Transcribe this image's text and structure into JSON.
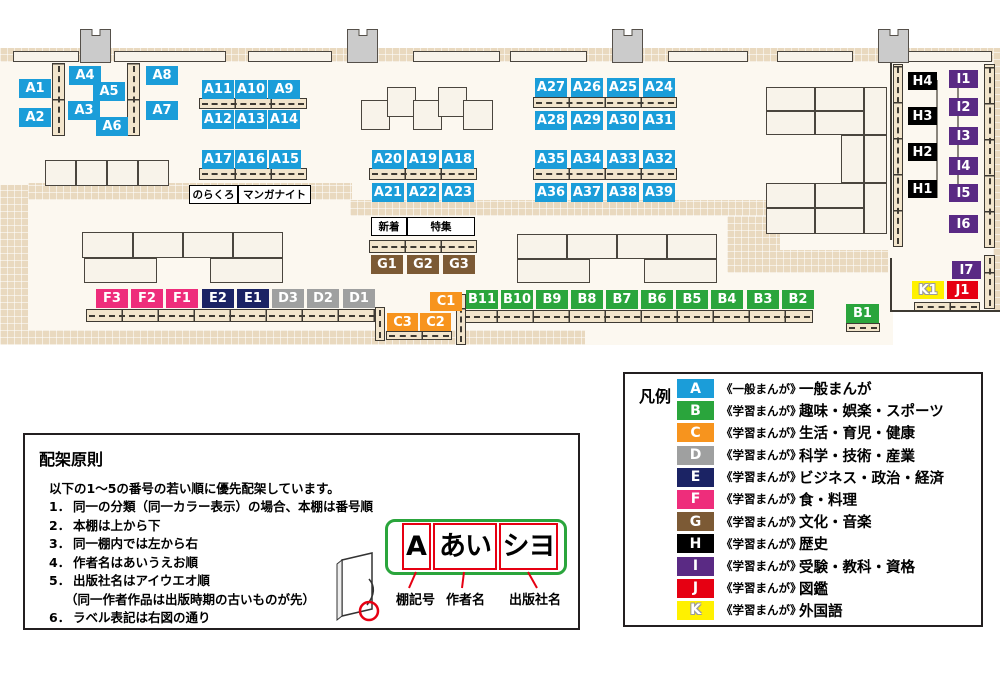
{
  "legend": {
    "title": "凡例",
    "items": [
      {
        "code": "A",
        "color": "#1b9dd9",
        "series": "《一般まんが》",
        "category": "一般まんが"
      },
      {
        "code": "B",
        "color": "#2aa53c",
        "series": "《学習まんが》",
        "category": "趣味・娯楽・スポーツ"
      },
      {
        "code": "C",
        "color": "#f7941e",
        "series": "《学習まんが》",
        "category": "生活・育児・健康"
      },
      {
        "code": "D",
        "color": "#9fa0a0",
        "series": "《学習まんが》",
        "category": "科学・技術・産業"
      },
      {
        "code": "E",
        "color": "#1b2364",
        "series": "《学習まんが》",
        "category": "ビジネス・政治・経済"
      },
      {
        "code": "F",
        "color": "#ee2d7b",
        "series": "《学習まんが》",
        "category": "食・料理"
      },
      {
        "code": "G",
        "color": "#7c5a35",
        "series": "《学習まんが》",
        "category": "文化・音楽"
      },
      {
        "code": "H",
        "color": "#000000",
        "series": "《学習まんが》",
        "category": "歴史"
      },
      {
        "code": "I",
        "color": "#5a2a84",
        "series": "《学習まんが》",
        "category": "受験・教科・資格"
      },
      {
        "code": "J",
        "color": "#e60012",
        "series": "《学習まんが》",
        "category": "図鑑"
      },
      {
        "code": "K",
        "color": "#fff100",
        "series": "《学習まんが》",
        "category": "外国語"
      }
    ]
  },
  "principles": {
    "title": "配架原則",
    "intro": "以下の1～5の番号の若い順に優先配架しています。",
    "items": [
      {
        "num": "1．",
        "text": "同一の分類（同一カラー表示）の場合、本棚は番号順",
        "sub": false
      },
      {
        "num": "2．",
        "text": "本棚は上から下",
        "sub": false
      },
      {
        "num": "3．",
        "text": "同一棚内では左から右",
        "sub": false
      },
      {
        "num": "4．",
        "text": "作者名はあいうえお順",
        "sub": false
      },
      {
        "num": "5．",
        "text": "出版社名はアイウエオ順",
        "sub": false
      },
      {
        "num": "",
        "text": "（同一作者作品は出版時期の古いものが先）",
        "sub": true
      },
      {
        "num": "6．",
        "text": "ラベル表記は右図の通り",
        "sub": false
      }
    ]
  },
  "label_diagram": {
    "shelf_code": "A",
    "author": "あい",
    "publisher": "シヨ",
    "captions": [
      "棚記号",
      "作者名",
      "出版社名"
    ]
  },
  "map": {
    "floors": [
      [
        0,
        48,
        893,
        297
      ],
      [
        893,
        48,
        107,
        264
      ]
    ],
    "bands": [
      [
        0,
        48,
        1000,
        14
      ],
      [
        0,
        185,
        28,
        160
      ],
      [
        28,
        183,
        324,
        17
      ],
      [
        350,
        200,
        430,
        16
      ],
      [
        727,
        216,
        53,
        57
      ],
      [
        727,
        250,
        161,
        23
      ],
      [
        28,
        330,
        557,
        15
      ],
      [
        993,
        48,
        7,
        264
      ]
    ],
    "walls": [
      [
        890,
        62,
        2,
        178
      ],
      [
        890,
        258,
        2,
        54
      ],
      [
        892,
        310,
        108,
        2
      ]
    ],
    "lines": [
      [
        936,
        80,
        2,
        118
      ],
      [
        957,
        78,
        2,
        116
      ]
    ],
    "pillars": [
      [
        80,
        29,
        31,
        34
      ],
      [
        347,
        29,
        31,
        34
      ],
      [
        612,
        29,
        31,
        34
      ],
      [
        878,
        29,
        31,
        34
      ]
    ],
    "tables": [
      [
        13,
        51,
        66,
        11
      ],
      [
        114,
        51,
        112,
        11
      ],
      [
        248,
        51,
        84,
        11
      ],
      [
        413,
        51,
        87,
        11
      ],
      [
        510,
        51,
        77,
        11
      ],
      [
        668,
        51,
        80,
        11
      ],
      [
        777,
        51,
        76,
        11
      ],
      [
        903,
        51,
        89,
        11
      ],
      [
        45,
        160,
        31,
        26
      ],
      [
        76,
        160,
        31,
        26
      ],
      [
        107,
        160,
        31,
        26
      ],
      [
        138,
        160,
        31,
        26
      ],
      [
        361,
        100,
        29,
        30
      ],
      [
        387,
        87,
        29,
        30
      ],
      [
        413,
        100,
        29,
        30
      ],
      [
        438,
        87,
        29,
        30
      ],
      [
        463,
        100,
        30,
        30
      ],
      [
        82,
        232,
        51,
        26
      ],
      [
        133,
        232,
        50,
        26
      ],
      [
        183,
        232,
        50,
        26
      ],
      [
        233,
        232,
        50,
        26
      ],
      [
        84,
        258,
        73,
        25
      ],
      [
        210,
        258,
        73,
        25
      ],
      [
        517,
        234,
        50,
        25
      ],
      [
        567,
        234,
        50,
        25
      ],
      [
        617,
        234,
        50,
        25
      ],
      [
        667,
        234,
        50,
        25
      ],
      [
        517,
        259,
        73,
        24
      ],
      [
        644,
        259,
        73,
        24
      ],
      [
        766,
        87,
        49,
        24
      ],
      [
        815,
        87,
        49,
        24
      ],
      [
        864,
        87,
        23,
        48
      ],
      [
        766,
        111,
        49,
        24
      ],
      [
        815,
        111,
        49,
        24
      ],
      [
        841,
        135,
        23,
        48
      ],
      [
        864,
        135,
        23,
        48
      ],
      [
        766,
        183,
        49,
        25
      ],
      [
        815,
        183,
        49,
        25
      ],
      [
        864,
        183,
        23,
        51
      ],
      [
        766,
        208,
        49,
        26
      ],
      [
        815,
        208,
        49,
        26
      ]
    ],
    "shelves_h": [
      [
        199,
        98,
        108,
        11
      ],
      [
        199,
        168,
        108,
        12
      ],
      [
        369,
        168,
        108,
        12
      ],
      [
        533,
        97,
        144,
        11
      ],
      [
        533,
        168,
        144,
        12
      ],
      [
        369,
        240,
        108,
        13
      ],
      [
        86,
        309,
        292,
        13
      ],
      [
        461,
        310,
        352,
        13
      ],
      [
        386,
        331,
        66,
        9
      ],
      [
        846,
        323,
        34,
        9
      ],
      [
        914,
        302,
        66,
        9
      ]
    ],
    "shelves_v": [
      [
        52,
        63,
        13,
        73
      ],
      [
        127,
        63,
        13,
        73
      ],
      [
        375,
        307,
        10,
        34
      ],
      [
        456,
        294,
        10,
        51
      ],
      [
        893,
        64,
        10,
        183
      ],
      [
        984,
        64,
        11,
        184
      ],
      [
        984,
        255,
        11,
        54
      ]
    ],
    "shelf_labels": [
      [
        "A1",
        "A",
        19,
        79
      ],
      [
        "A2",
        "A",
        19,
        108
      ],
      [
        "A4",
        "A",
        69,
        66
      ],
      [
        "A3",
        "A",
        68,
        101
      ],
      [
        "A5",
        "A",
        93,
        82
      ],
      [
        "A6",
        "A",
        96,
        117
      ],
      [
        "A8",
        "A",
        146,
        66
      ],
      [
        "A7",
        "A",
        146,
        101
      ],
      [
        "A11",
        "A",
        202,
        80
      ],
      [
        "A10",
        "A",
        235,
        80
      ],
      [
        "A9",
        "A",
        268,
        80
      ],
      [
        "A12",
        "A",
        202,
        110
      ],
      [
        "A13",
        "A",
        235,
        110
      ],
      [
        "A14",
        "A",
        268,
        110
      ],
      [
        "A17",
        "A",
        202,
        150
      ],
      [
        "A16",
        "A",
        235,
        150
      ],
      [
        "A15",
        "A",
        269,
        150
      ],
      [
        "A20",
        "A",
        372,
        150
      ],
      [
        "A19",
        "A",
        407,
        150
      ],
      [
        "A18",
        "A",
        442,
        150
      ],
      [
        "A21",
        "A",
        372,
        183
      ],
      [
        "A22",
        "A",
        407,
        183
      ],
      [
        "A23",
        "A",
        442,
        183
      ],
      [
        "A27",
        "A",
        535,
        78
      ],
      [
        "A26",
        "A",
        571,
        78
      ],
      [
        "A25",
        "A",
        607,
        78
      ],
      [
        "A24",
        "A",
        643,
        78
      ],
      [
        "A28",
        "A",
        535,
        111
      ],
      [
        "A29",
        "A",
        571,
        111
      ],
      [
        "A30",
        "A",
        607,
        111
      ],
      [
        "A31",
        "A",
        643,
        111
      ],
      [
        "A35",
        "A",
        535,
        150
      ],
      [
        "A34",
        "A",
        571,
        150
      ],
      [
        "A33",
        "A",
        607,
        150
      ],
      [
        "A32",
        "A",
        643,
        150
      ],
      [
        "A36",
        "A",
        535,
        183
      ],
      [
        "A37",
        "A",
        571,
        183
      ],
      [
        "A38",
        "A",
        607,
        183
      ],
      [
        "A39",
        "A",
        643,
        183
      ],
      [
        "G1",
        "G",
        371,
        255
      ],
      [
        "G2",
        "G",
        407,
        255
      ],
      [
        "G3",
        "G",
        443,
        255
      ],
      [
        "F3",
        "F",
        96,
        289
      ],
      [
        "F2",
        "F",
        131,
        289
      ],
      [
        "F1",
        "F",
        166,
        289
      ],
      [
        "E2",
        "E",
        202,
        289
      ],
      [
        "E1",
        "E",
        237,
        289
      ],
      [
        "D3",
        "D",
        272,
        289
      ],
      [
        "D2",
        "D",
        307,
        289
      ],
      [
        "D1",
        "D",
        343,
        289
      ],
      [
        "C1",
        "C",
        430,
        292
      ],
      [
        "C3",
        "C",
        387,
        313,
        31,
        18
      ],
      [
        "C2",
        "C",
        420,
        313,
        31,
        18
      ],
      [
        "B11",
        "B",
        466,
        290
      ],
      [
        "B10",
        "B",
        501,
        290
      ],
      [
        "B9",
        "B",
        536,
        290
      ],
      [
        "B8",
        "B",
        571,
        290
      ],
      [
        "B7",
        "B",
        606,
        290
      ],
      [
        "B6",
        "B",
        641,
        290
      ],
      [
        "B5",
        "B",
        676,
        290
      ],
      [
        "B4",
        "B",
        711,
        290
      ],
      [
        "B3",
        "B",
        747,
        290
      ],
      [
        "B2",
        "B",
        782,
        290
      ],
      [
        "B1",
        "B",
        846,
        304,
        33,
        19
      ],
      [
        "H4",
        "H",
        908,
        72,
        29,
        18
      ],
      [
        "H3",
        "H",
        908,
        107,
        29,
        18
      ],
      [
        "H2",
        "H",
        908,
        143,
        29,
        18
      ],
      [
        "H1",
        "H",
        908,
        180,
        29,
        18
      ],
      [
        "I1",
        "I",
        949,
        70,
        29,
        18
      ],
      [
        "I2",
        "I",
        949,
        98,
        29,
        18
      ],
      [
        "I3",
        "I",
        949,
        127,
        29,
        18
      ],
      [
        "I4",
        "I",
        949,
        157,
        29,
        18
      ],
      [
        "I5",
        "I",
        949,
        184,
        29,
        18
      ],
      [
        "I6",
        "I",
        949,
        215,
        29,
        18
      ],
      [
        "I7",
        "I",
        952,
        261,
        29,
        18
      ],
      [
        "K1",
        "K",
        912,
        281,
        32,
        18
      ],
      [
        "J1",
        "J",
        947,
        281,
        31,
        18
      ]
    ],
    "annotations": [
      [
        "のらくろ",
        189,
        185,
        47,
        17
      ],
      [
        "マンガナイト",
        238,
        185,
        71,
        17
      ],
      [
        "新着",
        371,
        217,
        34,
        17
      ],
      [
        "特集",
        407,
        217,
        66,
        17
      ]
    ]
  }
}
